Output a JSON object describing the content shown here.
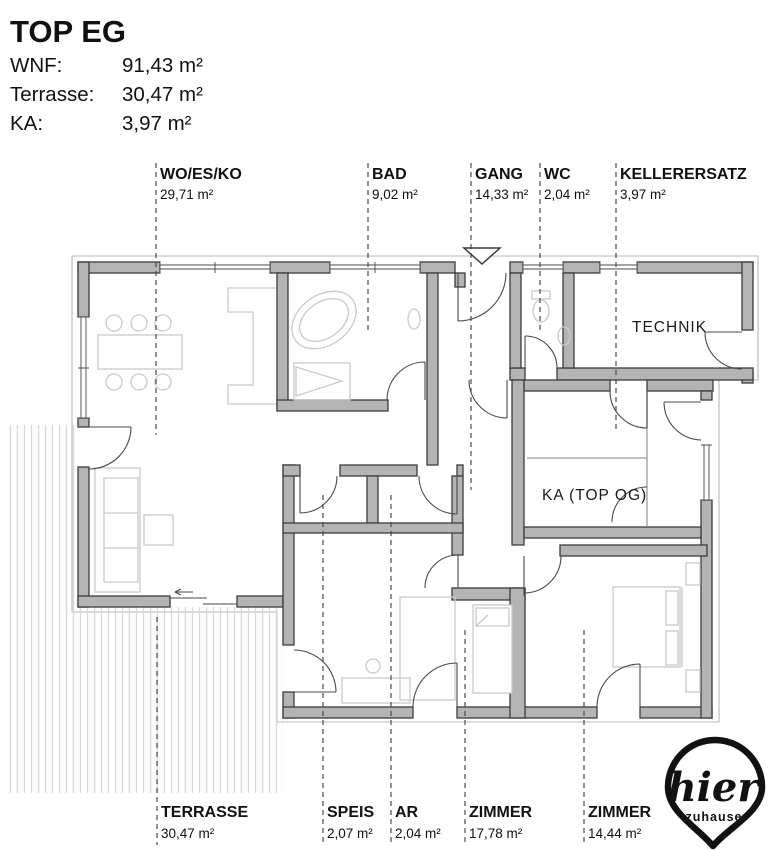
{
  "header": {
    "title": "TOP EG",
    "rows": [
      {
        "label": "WNF:",
        "value": "91,43 m²"
      },
      {
        "label": "Terrasse:",
        "value": "30,47 m²"
      },
      {
        "label": "KA:",
        "value": "3,97 m²"
      }
    ]
  },
  "labels": {
    "top": [
      {
        "name": "WO/ES/KO",
        "area": "29,71 m²"
      },
      {
        "name": "BAD",
        "area": "9,02 m²"
      },
      {
        "name": "GANG",
        "area": "14,33 m²"
      },
      {
        "name": "WC",
        "area": "2,04 m²"
      },
      {
        "name": "KELLERERSATZ",
        "area": "3,97 m²"
      }
    ],
    "bottom": [
      {
        "name": "TERRASSE",
        "area": "30,47 m²"
      },
      {
        "name": "SPEIS",
        "area": "2,07 m²"
      },
      {
        "name": "AR",
        "area": "2,04 m²"
      },
      {
        "name": "ZIMMER",
        "area": "17,78 m²"
      },
      {
        "name": "ZIMMER",
        "area": "14,44 m²"
      }
    ]
  },
  "plan": {
    "room_labels": [
      {
        "text": "TECHNIK"
      },
      {
        "text": "KA (TOP OG)"
      }
    ]
  },
  "logo": {
    "line1": "hier",
    "line2": "zuhause"
  },
  "colors": {
    "wall_fill": "#b4b4b4",
    "wall_stroke": "#3c3c3c",
    "furniture": "#c9c9c9",
    "dash": "#4a4a4a",
    "terrace_stripe": "#d8d8d8",
    "text": "#111111"
  }
}
